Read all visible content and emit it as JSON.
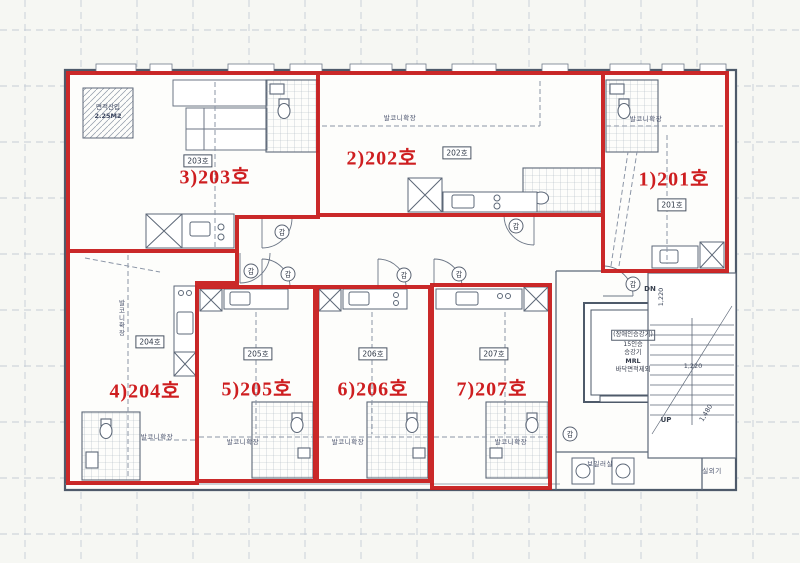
{
  "units": [
    {
      "no": "1",
      "label": "1)201호",
      "tag": "201호"
    },
    {
      "no": "2",
      "label": "2)202호",
      "tag": "202호"
    },
    {
      "no": "3",
      "label": "3)203호",
      "tag": "203호"
    },
    {
      "no": "4",
      "label": "4)204호",
      "tag": "204호"
    },
    {
      "no": "5",
      "label": "5)205호",
      "tag": "205호"
    },
    {
      "no": "6",
      "label": "6)206호",
      "tag": "206호"
    },
    {
      "no": "7",
      "label": "7)207호",
      "tag": "207호"
    }
  ],
  "notes": {
    "area_incl_line1": "면적산입",
    "area_incl_line2": "2.25M2",
    "balcony_ext": "발코니확장",
    "boiler_room": "보일러실",
    "outdoor_ac": "실외기",
    "down": "DN",
    "up": "UP",
    "dim_stair_width": "1,220",
    "dim_stair_depth": "1,220",
    "dim_stair_run": "1,480",
    "door_mark": "갑"
  },
  "elevator": {
    "line1": "(장애인승강기)",
    "line2": "15인승",
    "line3": "승강기",
    "line4": "MRL",
    "line5": "바닥면적제외"
  },
  "colors": {
    "unit_outline": "#c81e1e",
    "label_red": "#ce1e20",
    "wall": "#4e5a6a",
    "grid": "#c5ccd6"
  }
}
